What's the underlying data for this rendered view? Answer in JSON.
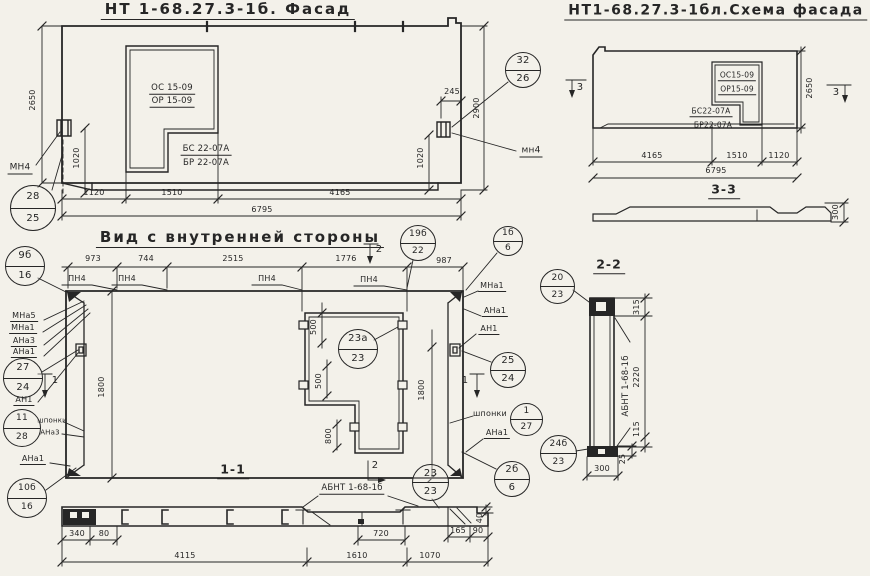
{
  "facade": {
    "title": "НТ 1-68.27.3-1б. Фасад",
    "win_top": "ОС 15-09",
    "win_bot": "ОР 15-09",
    "sill_top": "БС 22-07А",
    "sill_bot": "БР 22-07А",
    "h_left": "2650",
    "h_right": "2900",
    "v1020": "1020",
    "d245": "245",
    "d1": "1120",
    "d2": "1510",
    "d3": "4165",
    "total": "6795",
    "mn4": "МН4",
    "mn4_small": "мн4"
  },
  "scheme": {
    "title": "НТ1-68.27.3-1бл.Схема фасада",
    "win_top": "ОС15-09",
    "win_bot": "ОР15-09",
    "sill_top": "БС22-07А",
    "sill_bot": "БР22-07А",
    "d1": "4165",
    "d2": "1510",
    "d3": "1120",
    "total": "6795",
    "height": "2650",
    "mark": "3",
    "section_title": "3-3",
    "d300": "300"
  },
  "inner": {
    "title": "Вид с внутренней стороны",
    "d1": "973",
    "d2": "744",
    "d3": "2515",
    "d4": "1776",
    "d5": "987",
    "pn4": "ПН4",
    "mark1": "1",
    "mark2": "2",
    "mna5": "МНа5",
    "mna1": "МНа1",
    "ana3": "АНа3",
    "ana1": "АНа1",
    "an1": "АН1",
    "shponki": "шпонки",
    "d1800": "1800",
    "d500": "500",
    "d800": "800"
  },
  "s11": {
    "title": "1-1",
    "d340": "340",
    "d80": "80",
    "d720": "720",
    "d165": "165",
    "d90": "90",
    "d40": "40",
    "d4115": "4115",
    "d1610": "1610",
    "d1070": "1070"
  },
  "s22": {
    "title": "2-2",
    "d315": "315",
    "d2220": "2220",
    "d115": "115",
    "d25": "25",
    "d300": "300"
  },
  "abnt": "АБНТ 1-68-1б",
  "circles": [
    {
      "top": "28",
      "bottom": "25"
    },
    {
      "top": "32",
      "bottom": "26"
    },
    {
      "top": "9б",
      "bottom": "16"
    },
    {
      "top": "27",
      "bottom": "24"
    },
    {
      "top": "11",
      "bottom": "28"
    },
    {
      "top": "10б",
      "bottom": "16"
    },
    {
      "top": "19б",
      "bottom": "22"
    },
    {
      "top": "1б",
      "bottom": "6"
    },
    {
      "top": "25",
      "bottom": "24"
    },
    {
      "top": "1",
      "bottom": "27"
    },
    {
      "top": "2б",
      "bottom": "6"
    },
    {
      "top": "23а",
      "bottom": "23"
    },
    {
      "top": "20",
      "bottom": "23"
    },
    {
      "top": "24б",
      "bottom": "23"
    },
    {
      "top": "23",
      "bottom": "23"
    }
  ]
}
